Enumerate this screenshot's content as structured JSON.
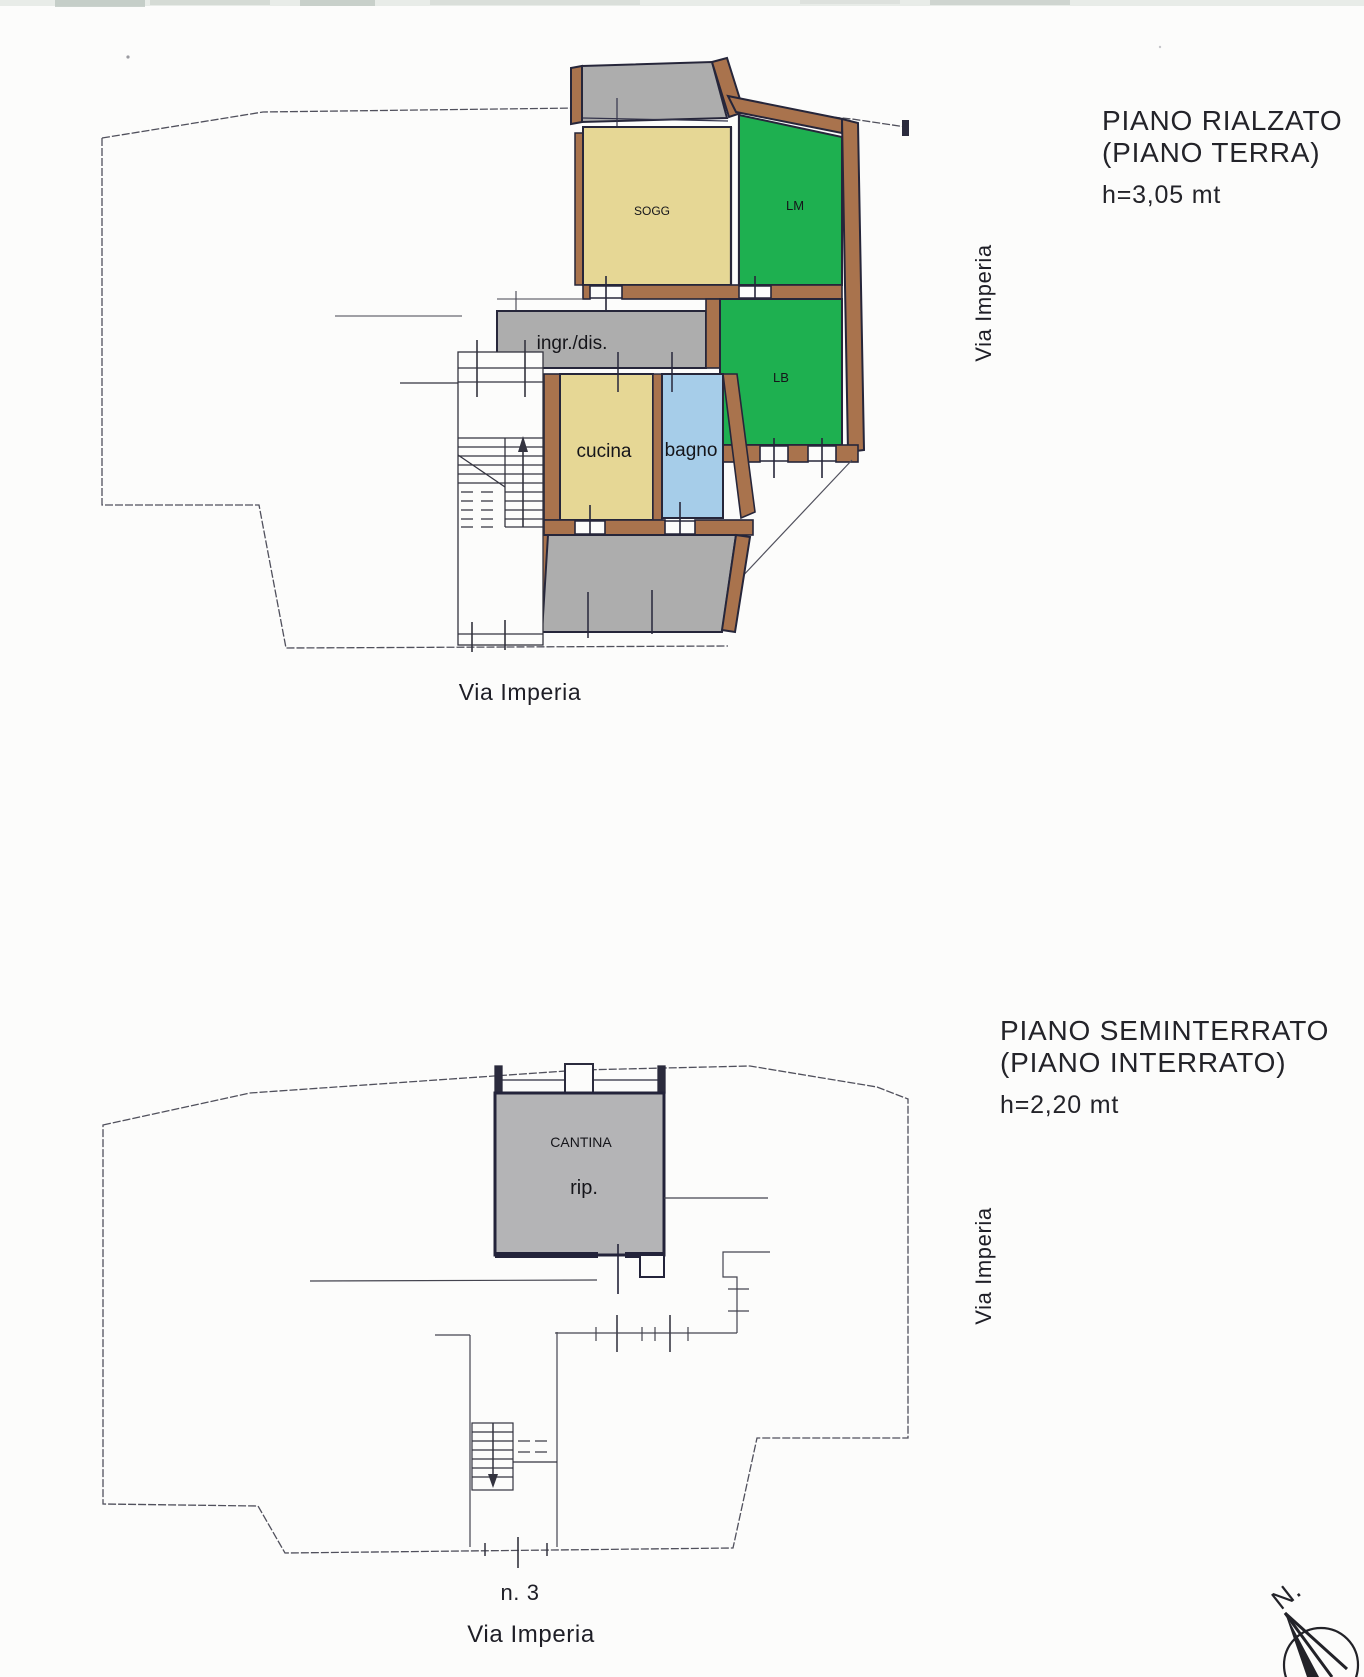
{
  "colors": {
    "paper": "#fcfcfb",
    "room_tan": "#e6d795",
    "room_green": "#1eb050",
    "room_blue": "#a6cde9",
    "room_gray": "#adadad",
    "basement_gray": "#b4b4b6",
    "wall_brown": "#a9734d",
    "wall_dark": "#26263a",
    "thin_line": "#50505c"
  },
  "upper_plan": {
    "title_line1": "PIANO RIALZATO",
    "title_line2": "(PIANO TERRA)",
    "height_label": "h=3,05 mt",
    "street_right_label": "Via Imperia",
    "street_bottom_label": "Via Imperia",
    "rooms": {
      "sogg": "SOGG",
      "lm": "LM",
      "ingr": "ingr./dis.",
      "cucina": "cucina",
      "bagno": "bagno",
      "lb": "LB"
    }
  },
  "lower_plan": {
    "title_line1": "PIANO SEMINTERRATO",
    "title_line2": "(PIANO INTERRATO)",
    "height_label": "h=2,20 mt",
    "street_right_label": "Via Imperia",
    "street_number": "n. 3",
    "street_bottom_label": "Via Imperia",
    "rooms": {
      "cantina": "CANTINA",
      "rip": "rip."
    }
  },
  "compass": {
    "north_label": "N."
  }
}
